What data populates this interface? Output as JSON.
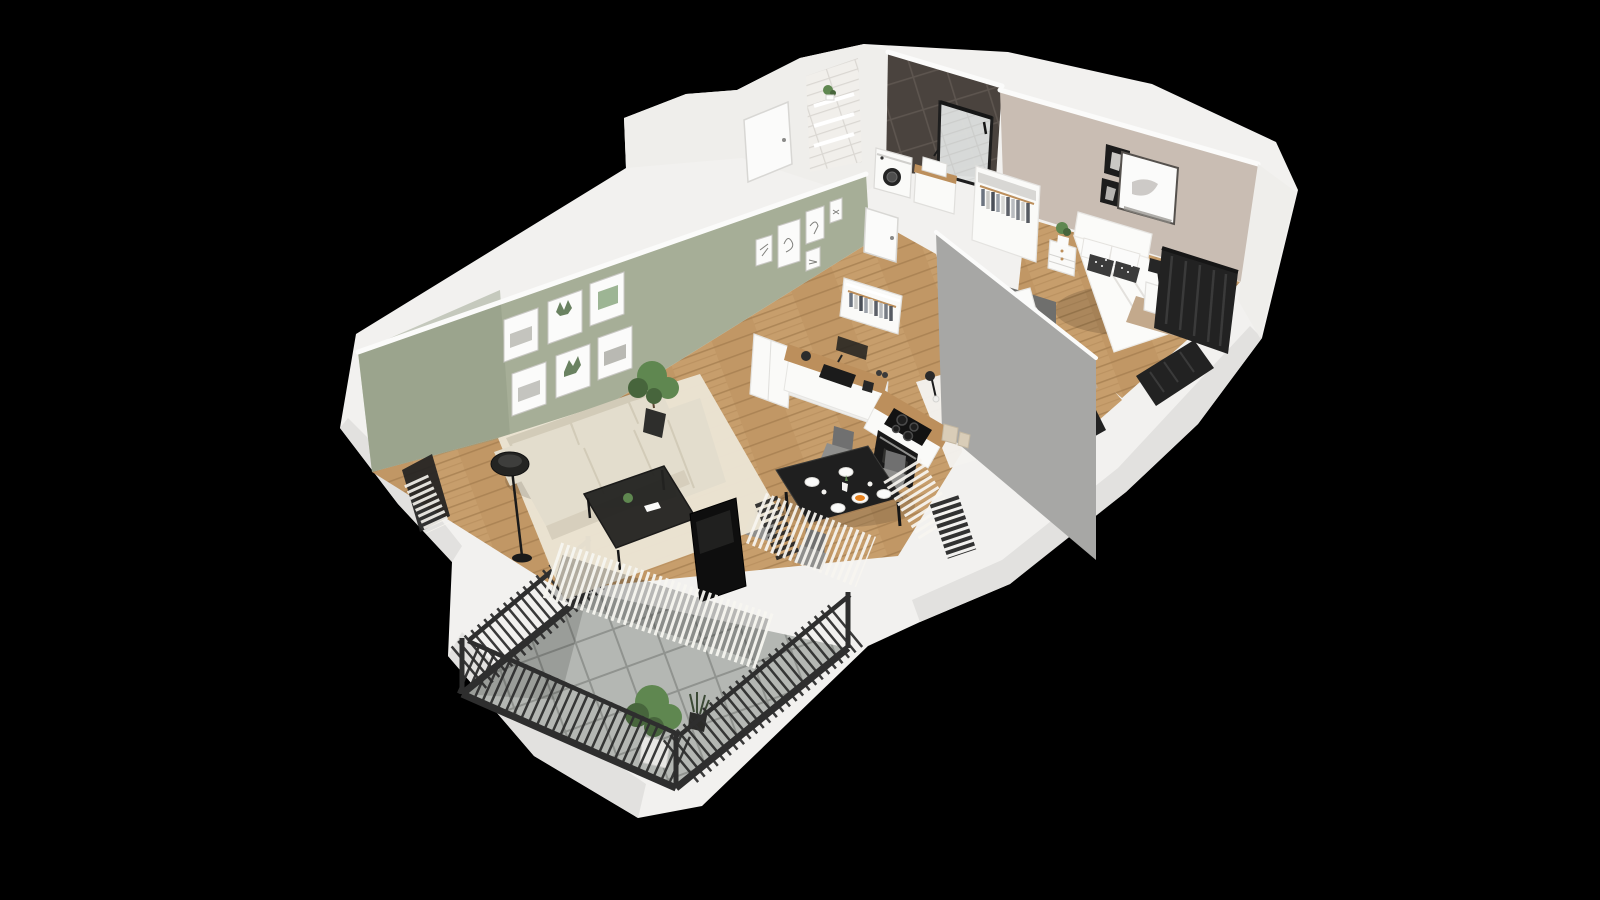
{
  "scene": {
    "type": "3d-floor-plan-render",
    "description": "Isometric cutaway 3D render of a furnished one/two-bedroom apartment on a black background, viewed from above at an angle",
    "background": "#000000",
    "visible_text": "none"
  },
  "palette": {
    "bg": "#000000",
    "shell": "#f2f1ef",
    "shellShade": "#e2e1df",
    "wallWhite": "#efeeeb",
    "capWhite": "#fbfbfa",
    "sage": "#a6ae97",
    "sageShade": "#8d9a80",
    "beige": "#c9bdb3",
    "grayWall": "#a7a7a5",
    "grayAccent": "#6f6f6d",
    "darkTile": "#4a433e",
    "darkTileLine": "#5d554f",
    "subway": "#f1efeb",
    "subwayLine": "#dad7d2",
    "wood": "#c79e6c",
    "woodDark": "#b58a58",
    "woodLine": "#a37c4e",
    "woodTop": "#bc8f5c",
    "balconyTile": "#b4b7b3",
    "balconyLine": "#90938f",
    "railing": "#2e2e2e",
    "curtainDark": "#222222",
    "curtainSheer": "#f7f5f0",
    "sofa": "#e3ddcd",
    "sofaShade": "#d2cbb8",
    "rug": "#ebe4d4",
    "rugWhite": "#f4f3ef",
    "furnBlack": "#1f1f1f",
    "applianceWhite": "#fafaf8",
    "bedWhite": "#fbfbf9",
    "pillowDark": "#3b3b3b",
    "pillowYellow": "#d8c267",
    "blanketTan": "#c3a98c",
    "plantGreen": "#5f8750",
    "plantDeep": "#47653c",
    "orange": "#e8821e",
    "chairGray": "#8f8f8d",
    "chairDark": "#707070",
    "glass": "#cdd3d5"
  },
  "rooms": [
    {
      "id": "living-room",
      "label": "Living room with sage green gallery wall, corner sofa, coffee table, floor lamp, TV and sheer curtains"
    },
    {
      "id": "kitchen-dining",
      "label": "Open kitchen with L-shaped counter, sink, hob and oven, plus black dining table with four chairs"
    },
    {
      "id": "hallway",
      "label": "Hallway with entry door, tiled shelf niche, bathroom door and open wardrobe"
    },
    {
      "id": "bathroom",
      "label": "Bathroom with dark tiled walls, corner shower, washing machine and vanity sink"
    },
    {
      "id": "bedroom-master",
      "label": "Master bedroom with double bed, nightstands, wardrobe, wall art and dark curtains"
    },
    {
      "id": "bedroom-second",
      "label": "Second bedroom with single bed, under-bed storage, patterned rug and reading lamp"
    },
    {
      "id": "balcony",
      "label": "Balcony with grey tiled floor, dark metal railing and potted plants"
    }
  ]
}
